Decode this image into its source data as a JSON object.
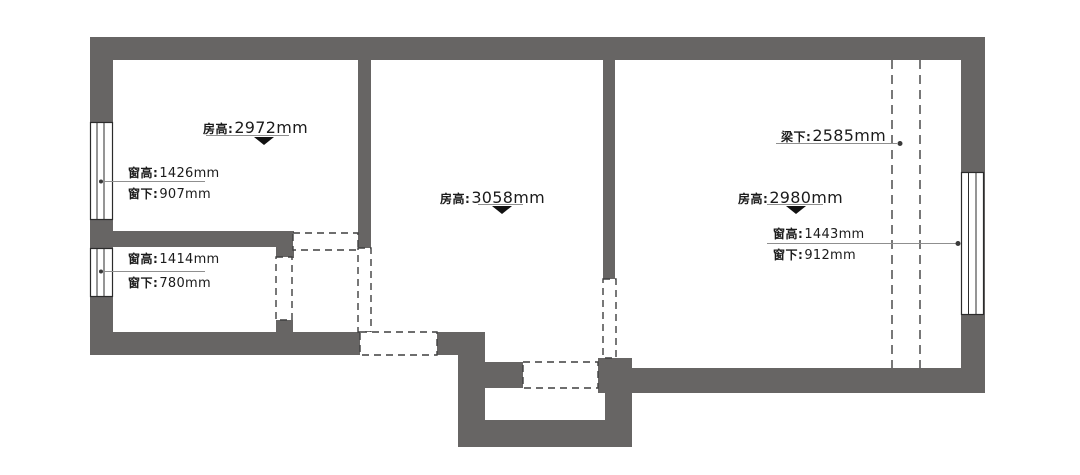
{
  "type": "residential-floor-plan",
  "colors": {
    "wall": "#676564",
    "dash": "#3f3f3f",
    "leader": "#8f8f8f",
    "text": "#1b1b1b"
  },
  "annotations": {
    "room1_height": {
      "label": "房高:",
      "value": "2972mm"
    },
    "room1_window_height": {
      "label": "窗高:",
      "value": "1426mm"
    },
    "room1_window_below": {
      "label": "窗下:",
      "value": "907mm"
    },
    "small_room_window_height": {
      "label": "窗高:",
      "value": "1414mm"
    },
    "small_room_window_below": {
      "label": "窗下:",
      "value": "780mm"
    },
    "room2_height": {
      "label": "房高:",
      "value": "3058mm"
    },
    "room3_beam_below": {
      "label": "梁下:",
      "value": "2585mm"
    },
    "room3_height": {
      "label": "房高:",
      "value": "2980mm"
    },
    "room3_window_height": {
      "label": "窗高:",
      "value": "1443mm"
    },
    "room3_window_below": {
      "label": "窗下:",
      "value": "912mm"
    }
  },
  "icons": {
    "down_arrow": "ceiling-height-marker",
    "leader_dot": "leader-endpoint"
  }
}
